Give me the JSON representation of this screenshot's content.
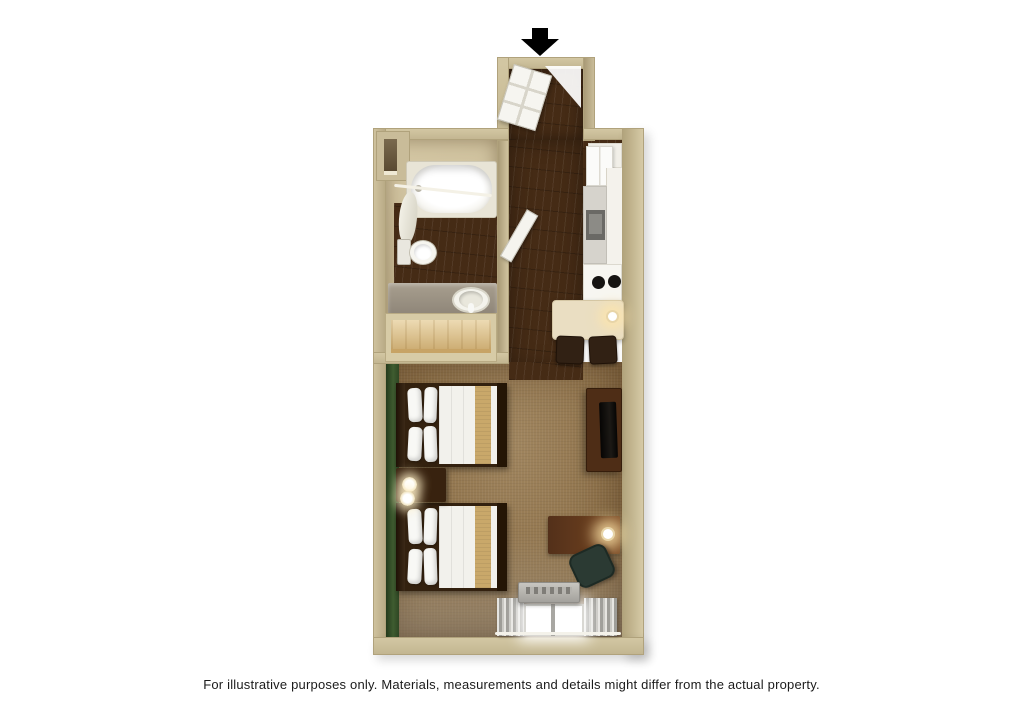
{
  "caption": {
    "text": "For illustrative purposes only.  Materials, measurements and details might differ from the actual property."
  },
  "floorplan": {
    "entrance_arrow": {
      "label": "Entrance"
    },
    "rooms": {
      "entry": {
        "label": "Entry vestibule"
      },
      "bathroom": {
        "label": "Bathroom"
      },
      "kitchen": {
        "label": "Kitchenette"
      },
      "living": {
        "label": "Living and sleeping area"
      }
    },
    "furniture": {
      "entry_door": "Entry door",
      "bathroom_door": "Bathroom door",
      "bathtub": "Bathtub with shower curtain",
      "toilet": "Toilet",
      "vanity_sink": "Vanity with sink",
      "closet": "Closet",
      "refrigerator": "Refrigerator",
      "microwave": "Microwave",
      "stove": "Two-burner stove",
      "dining_table": "Dining table with lamp",
      "dining_chair": "Dining chair",
      "bed_1": "Bed 1",
      "bed_2": "Bed 2",
      "nightstand": "Nightstand with lamps",
      "tv_console": "TV console",
      "tv": "Television",
      "desk": "Desk with lamp",
      "desk_chair": "Desk chair",
      "ac_unit": "Air-conditioning unit",
      "window": "Window with curtains"
    },
    "colors": {
      "background": "#ffffff",
      "wall_tan": "#c9bc99",
      "wood_floor": "#452b15",
      "carpet": "#8d7048",
      "accent_green": "#3f5c30",
      "bed_runner_khaki": "#c9a86a",
      "closet_wood": "#e5cb92",
      "arrow_black": "#000000",
      "caption_text": "#1b1b1b"
    }
  }
}
